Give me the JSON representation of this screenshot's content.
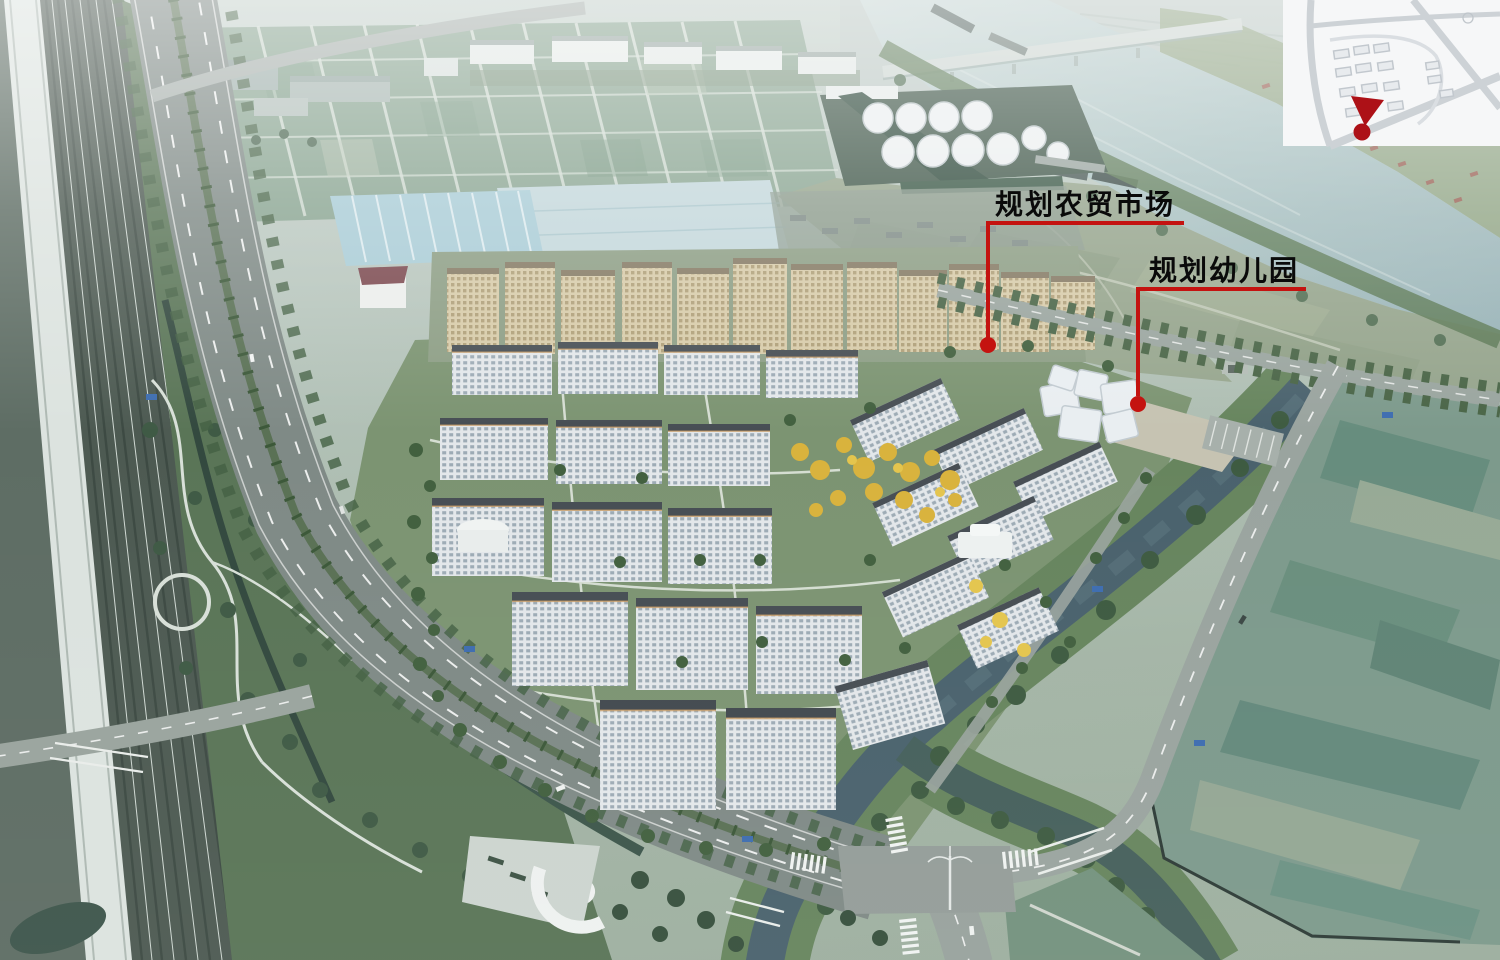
{
  "annotations": {
    "items": [
      {
        "id": "planned-farmers-market",
        "label": "规划农贸市场"
      },
      {
        "id": "planned-kindergarten",
        "label": "规划幼儿园"
      }
    ]
  },
  "inset_map": {
    "marker_icon": "location-pin-icon"
  },
  "palette": {
    "annotation_red": "#c41310",
    "pin_red": "#ad1117",
    "label_text": "#0a0a0a",
    "river_water": "#a5bec0",
    "canal_water": "#4a626d",
    "farmland_green": "#8aa592",
    "ginkgo_yellow": "#d9b33d",
    "building_roof": "#474e54",
    "construction_netting": "#5d8a76"
  }
}
